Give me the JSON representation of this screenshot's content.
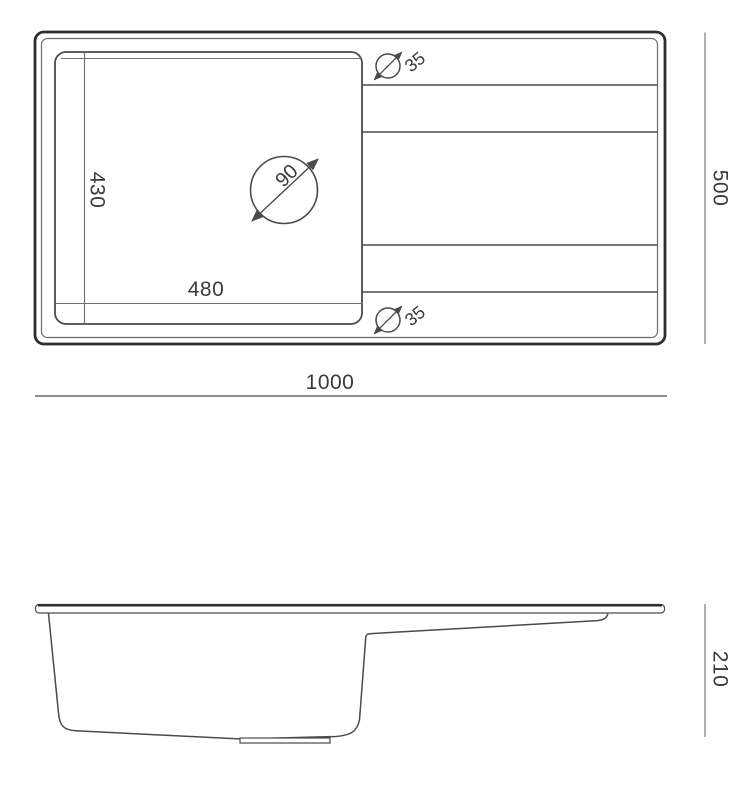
{
  "drawing": {
    "type_label": "sink-technical-drawing"
  },
  "top_view": {
    "width_label": "1000",
    "depth_label": "500",
    "bowl_width_label": "480",
    "bowl_depth_label": "430",
    "drain_diameter_label": "90",
    "tap_hole_labels": [
      "35",
      "35"
    ]
  },
  "side_view": {
    "height_label": "210"
  },
  "colors": {
    "background": "#ffffff",
    "line_dark": "#2e2e2e",
    "line_mid": "#4a4a4a",
    "line_light": "#6e6e6e",
    "dim_line": "#8f8f8f",
    "text": "#3a3a3a"
  }
}
